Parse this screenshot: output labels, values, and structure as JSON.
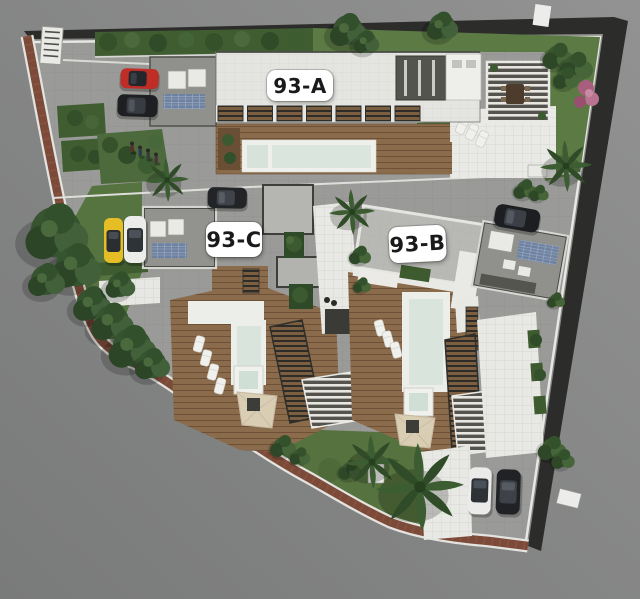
{
  "page": {
    "title": "Residential complex aerial site plan - 3D render"
  },
  "site_plan": {
    "view": "top-down aerial 3D architectural render of a walled triangular parcel",
    "units": [
      {
        "id": "93-A",
        "label": "93-A",
        "position": "north building with lap pool and pergola"
      },
      {
        "id": "93-C",
        "label": "93-C",
        "position": "south-west villa with pool deck"
      },
      {
        "id": "93-B",
        "label": "93-B",
        "position": "south-east villa with pool deck"
      }
    ],
    "amenities": [
      "swimming pools",
      "jacuzzis",
      "wood sun decks",
      "louvered pergolas",
      "lounge chairs",
      "gardens and hedges",
      "palm trees",
      "parking courts",
      "rooftop solar panels",
      "entrance gate"
    ],
    "vehicles": [
      {
        "color": "red",
        "area": "entrance court"
      },
      {
        "color": "black",
        "area": "entrance court"
      },
      {
        "color": "black",
        "area": "central drive"
      },
      {
        "color": "yellow",
        "area": "guest parking"
      },
      {
        "color": "white",
        "area": "guest parking"
      },
      {
        "color": "black",
        "area": "93-B drive"
      },
      {
        "color": "white",
        "area": "south parking"
      },
      {
        "color": "black",
        "area": "south parking"
      }
    ],
    "people_visible": 4,
    "palette": {
      "background": "#8a8a8a",
      "road": "#2c2c2a",
      "brick_path": "#7c4a39",
      "pavement": "#9a9a98",
      "roof_white": "#e4e4e0",
      "roof_gray": "#90908c",
      "deck_wood": "#8a6b4b",
      "pool_water": "#d8e4dc",
      "lawn": "#567440",
      "hedge": "#3f5d31",
      "label_bg": "#ffffff",
      "label_text": "#1a1a1a"
    }
  }
}
